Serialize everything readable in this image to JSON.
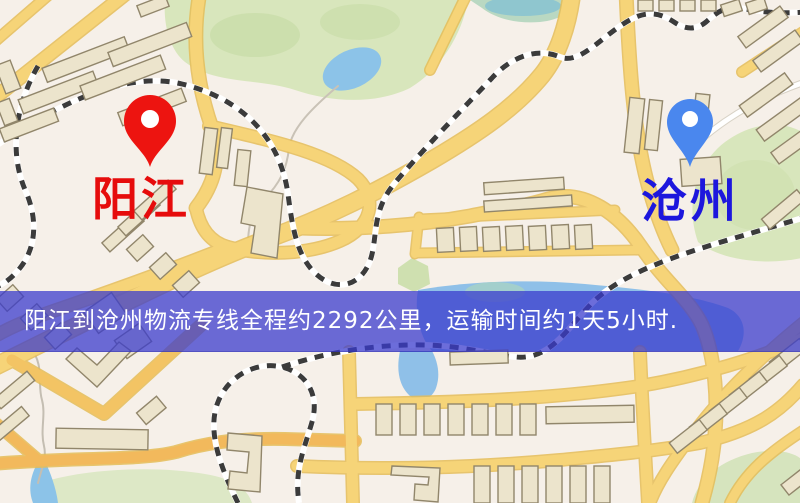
{
  "map": {
    "origin": {
      "name": "阳江",
      "pin_color": "#ed1410",
      "label_color": "#e60c0c"
    },
    "destination": {
      "name": "沧州",
      "pin_color": "#4a87ee",
      "label_color": "#1d17dd"
    },
    "banner": {
      "text": "阳江到沧州物流专线全程约2292公里，运输时间约1天5小时.",
      "bg_color": "#383acd",
      "text_color": "#ffffff"
    },
    "colors": {
      "background": "#f6f0e9",
      "road": "#f6d478",
      "road_casing": "#e5bd58",
      "water": "#8fc0e8",
      "park": "#d8e6bc",
      "building": "#ece4cc",
      "building_outline": "#91866b",
      "railway_dash": "#3b3b3b"
    }
  }
}
